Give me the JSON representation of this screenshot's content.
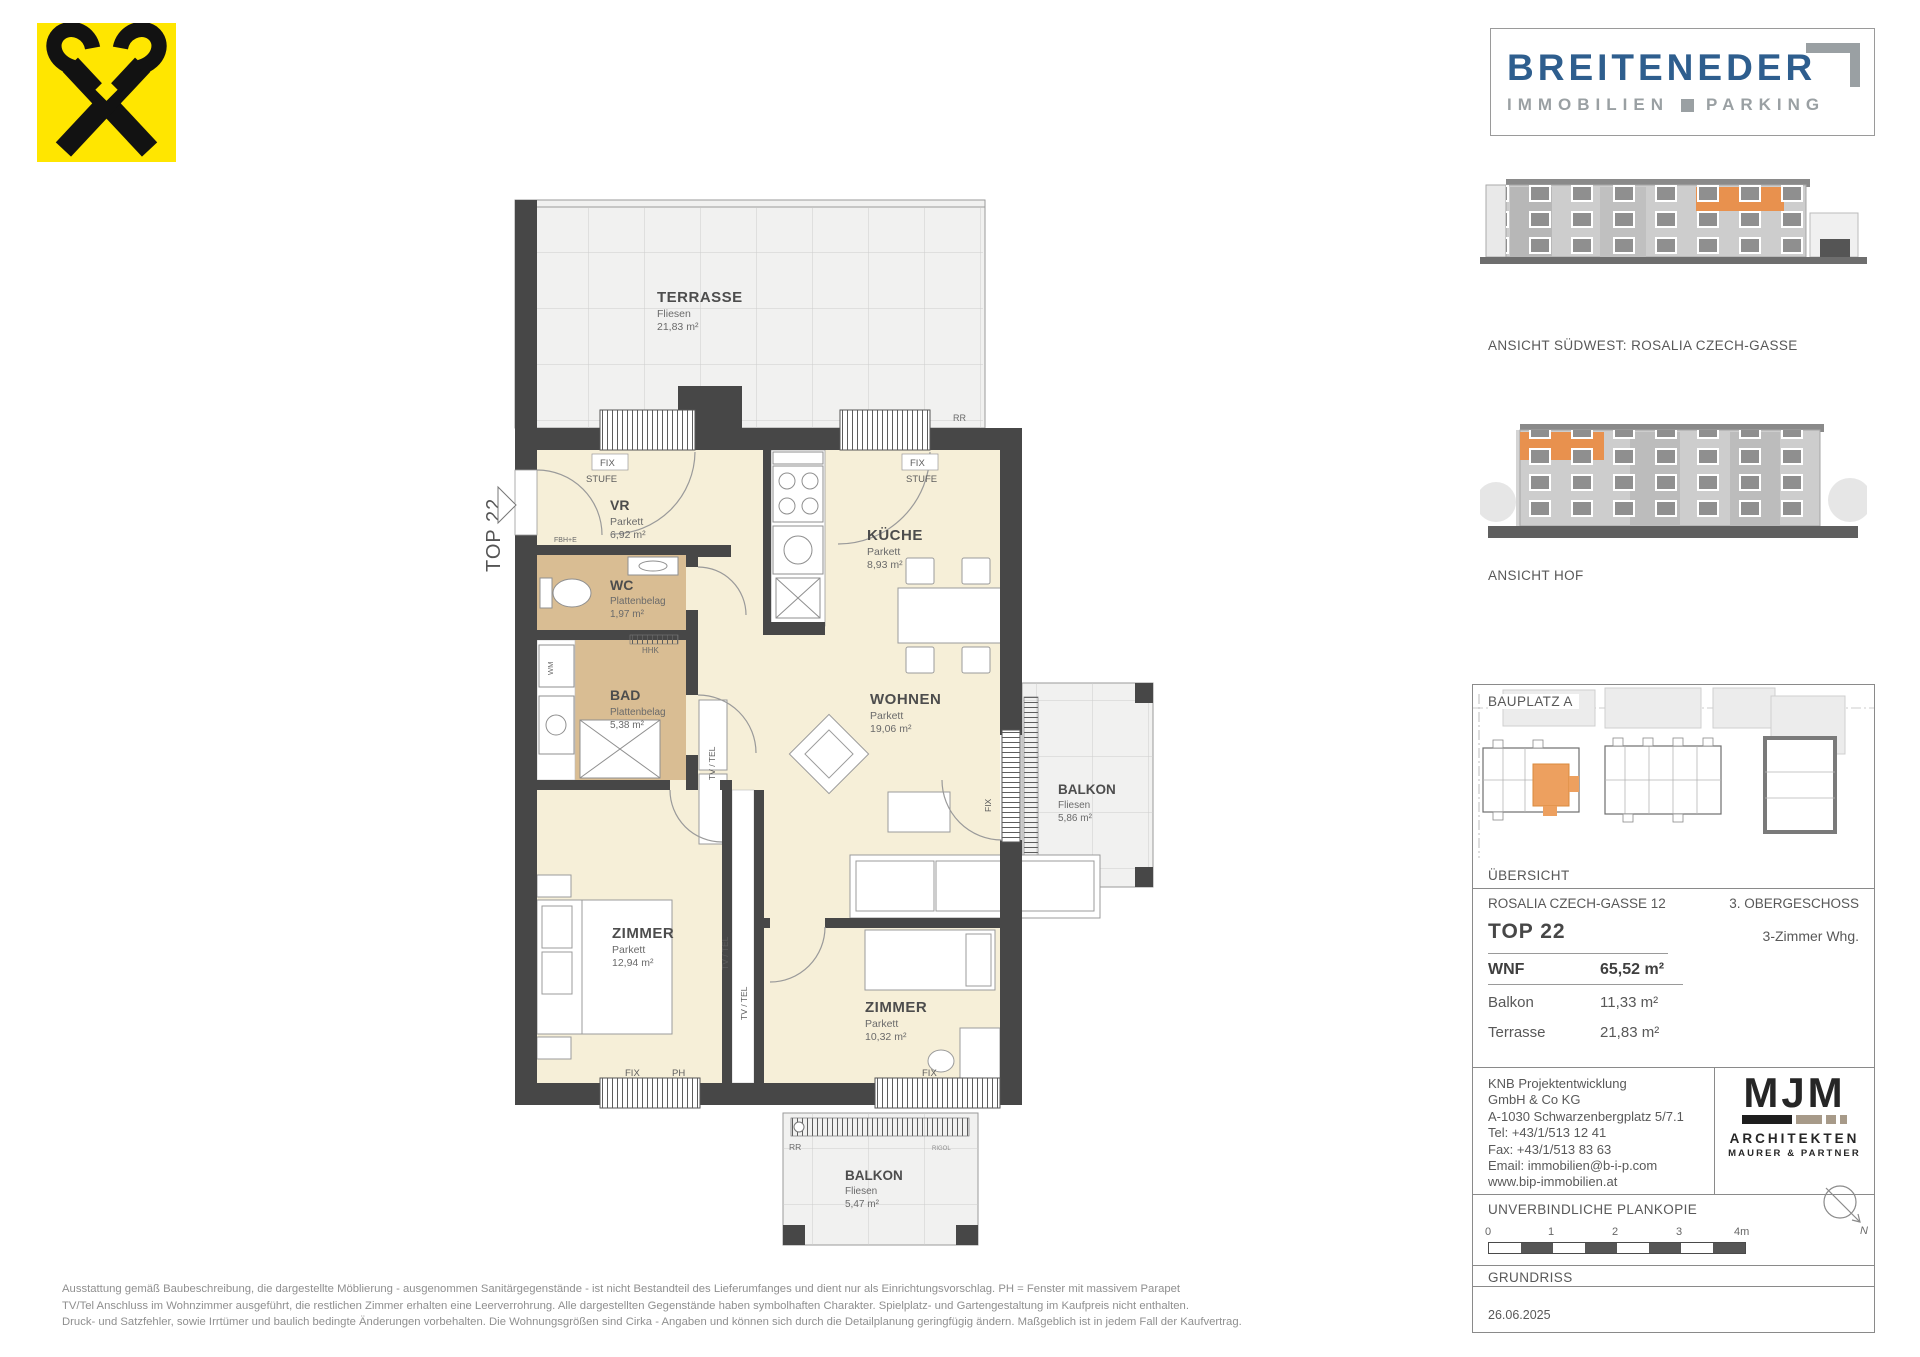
{
  "colors": {
    "accent_orange": "#E8914E",
    "wall": "#474747",
    "room_cream": "#F6EFD8",
    "room_tile": "#D9BD93",
    "brand_blue": "#2E5E8E",
    "brand_gray": "#9AA0A3",
    "raiffeisen_yellow": "#FFE600"
  },
  "raiffeisen": {
    "icon": "raiffeisen-giebelkreuz"
  },
  "breiteneder": {
    "name": "BREITENEDER",
    "word_left": "IMMOBILIEN",
    "word_right": "PARKING"
  },
  "elevations": {
    "southwest_caption": "ANSICHT SÜDWEST: ROSALIA CZECH-GASSE",
    "hof_caption": "ANSICHT HOF"
  },
  "siteplan": {
    "title": "BAUPLATZ  A",
    "caption": "ÜBERSICHT"
  },
  "info": {
    "address": "ROSALIA CZECH-GASSE 12",
    "floor": "3. OBERGESCHOSS",
    "unit": "TOP 22",
    "unit_type": "3-Zimmer Whg.",
    "rows": {
      "wnf": {
        "label": "WNF",
        "value": "65,52 m²"
      },
      "balkon": {
        "label": "Balkon",
        "value": "11,33 m²"
      },
      "terrasse": {
        "label": "Terrasse",
        "value": "21,83 m²"
      }
    }
  },
  "contact": {
    "l1": "KNB Projektentwicklung",
    "l2": "GmbH & Co KG",
    "l3": "A-1030 Schwarzenbergplatz 5/7.1",
    "l4": "Tel: +43/1/513 12 41",
    "l5": "Fax: +43/1/513 83 63",
    "l6": "Email: immobilien@b-i-p.com",
    "l7": "www.bip-immobilien.at"
  },
  "architect": {
    "name": "MJM",
    "line1": "ARCHITEKTEN",
    "line2": "MAURER & PARTNER"
  },
  "plan_meta": {
    "copy_note": "UNVERBINDLICHE PLANKOPIE",
    "north_label": "N",
    "scale_0": "0",
    "scale_1": "1",
    "scale_2": "2",
    "scale_3": "3",
    "scale_4": "4m",
    "drawing_type": "GRUNDRISS",
    "date": "26.06.2025"
  },
  "floorplan": {
    "unit_arrow_label": "TOP 22",
    "rooms": {
      "terrasse": {
        "name": "TERRASSE",
        "finish": "Fliesen",
        "area": "21,83 m²"
      },
      "vr": {
        "name": "VR",
        "finish": "Parkett",
        "area": "6,92 m²"
      },
      "wc": {
        "name": "WC",
        "finish": "Plattenbelag",
        "area": "1,97 m²"
      },
      "kueche": {
        "name": "KÜCHE",
        "finish": "Parkett",
        "area": "8,93 m²"
      },
      "bad": {
        "name": "BAD",
        "finish": "Plattenbelag",
        "area": "5,38 m²"
      },
      "wohnen": {
        "name": "WOHNEN",
        "finish": "Parkett",
        "area": "19,06 m²"
      },
      "balkon_ost": {
        "name": "BALKON",
        "finish": "Fliesen",
        "area": "5,86 m²"
      },
      "zimmer_1": {
        "name": "ZIMMER",
        "finish": "Parkett",
        "area": "12,94 m²"
      },
      "zimmer_2": {
        "name": "ZIMMER",
        "finish": "Parkett",
        "area": "10,32 m²"
      },
      "balkon_sued": {
        "name": "BALKON",
        "finish": "Fliesen",
        "area": "5,47 m²"
      }
    },
    "labels": {
      "fix": "FIX",
      "stufe": "STUFE",
      "ph": "PH",
      "rr": "RR",
      "rigol": "RIGOL",
      "tv_tel": "TV / TEL",
      "wm": "WM",
      "hhk": "HHK",
      "fbh_e": "FBH+E"
    }
  },
  "disclaimer": {
    "line1": "Ausstattung gemäß Baubeschreibung, die dargestellte Möblierung - ausgenommen Sanitärgegenstände - ist nicht Bestandteil des Lieferumfanges und dient nur als Einrichtungsvorschlag. PH = Fenster mit massivem Parapet",
    "line2": "TV/Tel Anschluss im Wohnzimmer ausgeführt, die restlichen Zimmer erhalten eine Leerverrohrung. Alle dargestellten Gegenstände haben symbolhaften Charakter. Spielplatz- und Gartengestaltung im Kaufpreis nicht enthalten.",
    "line3": "Druck- und Satzfehler, sowie Irrtümer und baulich bedingte Änderungen vorbehalten. Die Wohnungsgrößen sind Cirka - Angaben und können sich durch die Detailplanung geringfügig ändern. Maßgeblich ist in jedem Fall der Kaufvertrag."
  }
}
